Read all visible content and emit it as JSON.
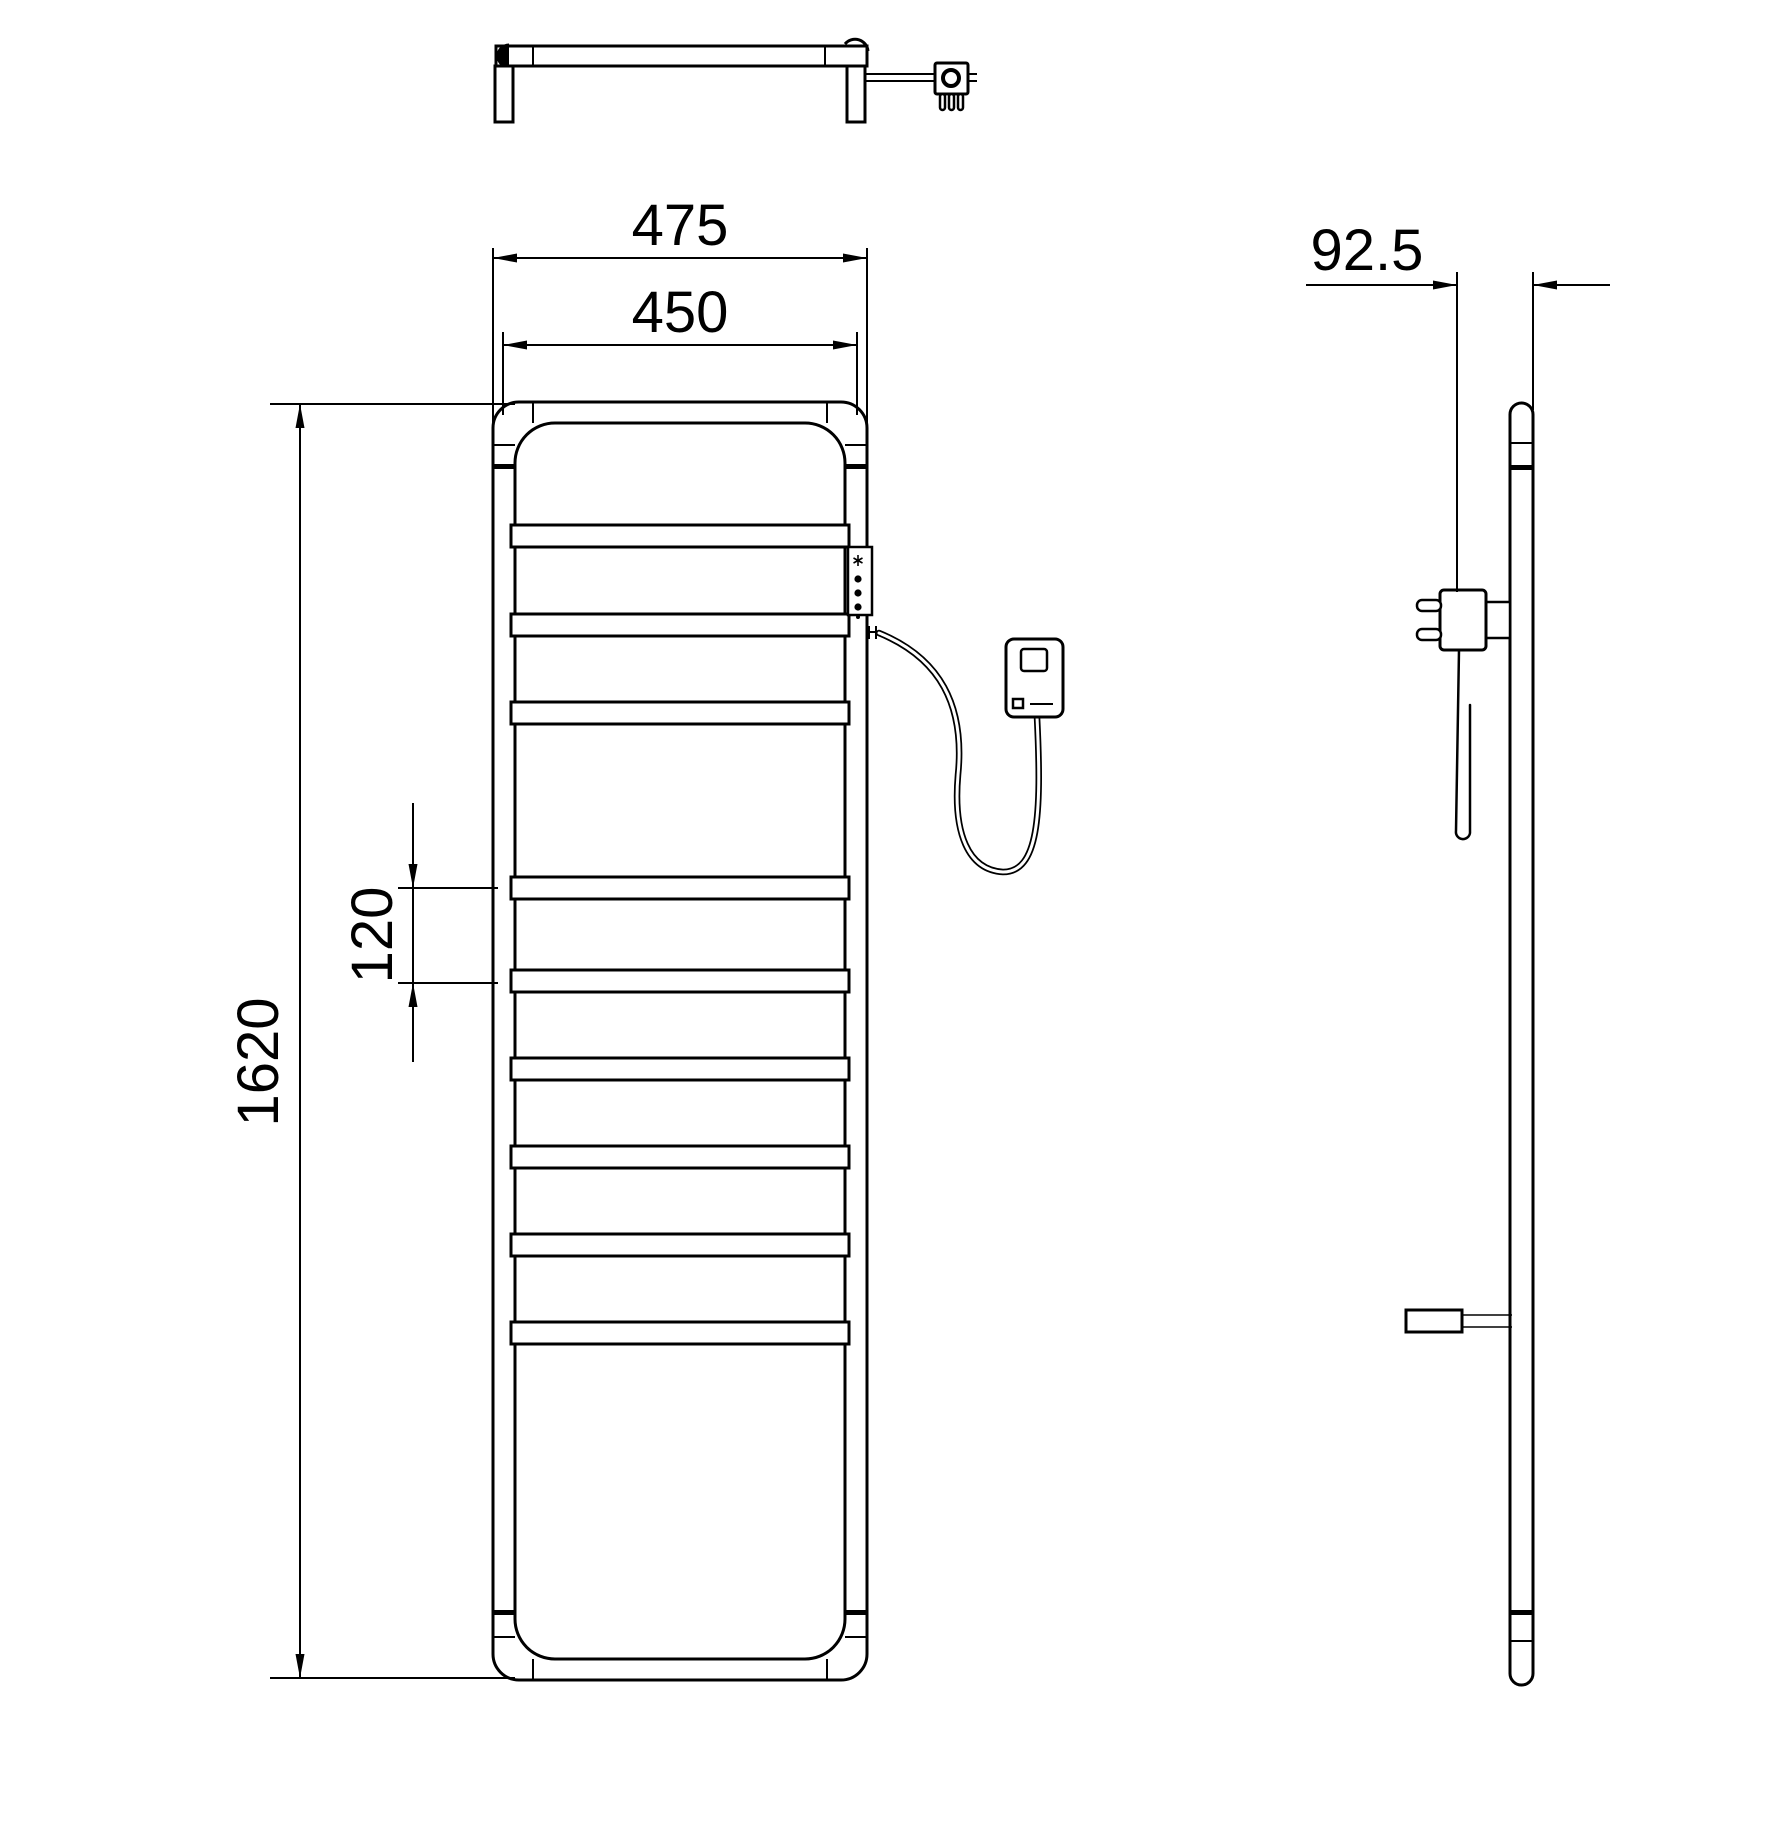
{
  "canvas": {
    "background": "#ffffff",
    "line_color": "#000000"
  },
  "dimensions": {
    "overall_width": "475",
    "top_bar_width": "450",
    "overall_height": "1620",
    "rung_spacing": "120",
    "wall_to_front_depth": "92.5"
  },
  "control_panel": {
    "icons": [
      "snowflake-icon",
      "led-dot",
      "led-dot",
      "led-dot",
      "led-dot-small"
    ]
  }
}
